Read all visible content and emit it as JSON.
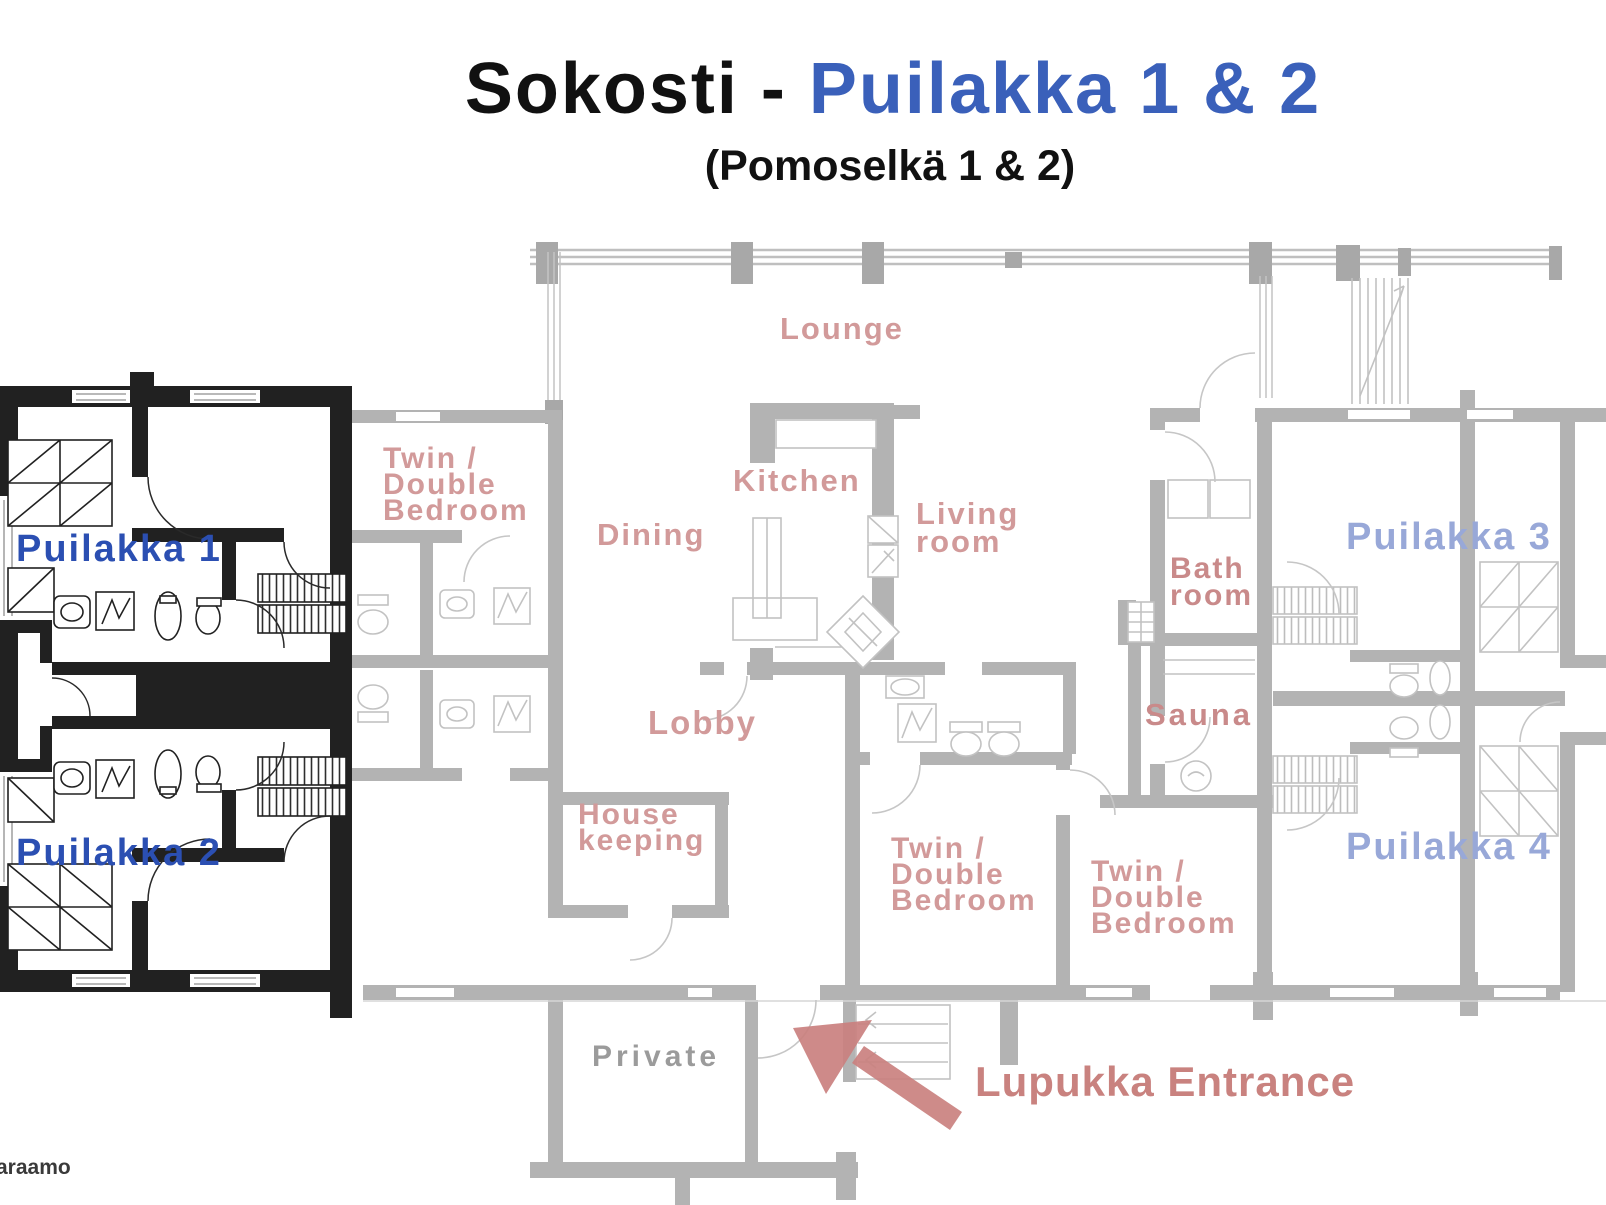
{
  "title": {
    "main_black": "Sokosti -",
    "main_blue": "Puilakka 1 & 2",
    "subtitle": "(Pomoselkä 1 & 2)"
  },
  "unit_labels": {
    "unit1": "Puilakka 1",
    "unit2": "Puilakka 2",
    "unit3": "Puilakka 3",
    "unit4": "Puilakka 4"
  },
  "room_labels": {
    "lounge": "Lounge",
    "kitchen": "Kitchen",
    "dining": "Dining",
    "living_room": "Living\nroom",
    "twin_double_bedroom": "Twin /\nDouble\nBedroom",
    "bath_room": "Bath\nroom",
    "sauna": "Sauna",
    "lobby": "Lobby",
    "housekeeping": "House\nkeeping",
    "private": "Private"
  },
  "annotations": {
    "entrance": "Lupukka Entrance",
    "watermark": "araamo"
  },
  "colors": {
    "highlighted_unit_walls": "#212121",
    "faded_plan_walls": "#b3b3b3",
    "unit_label_blue": "#2b4fb2",
    "faded_unit_label_blue": "#98a8d8",
    "room_label_pink": "#d29a9a",
    "entrance_pink": "#c9827f",
    "title_blue": "#3a60ba"
  }
}
